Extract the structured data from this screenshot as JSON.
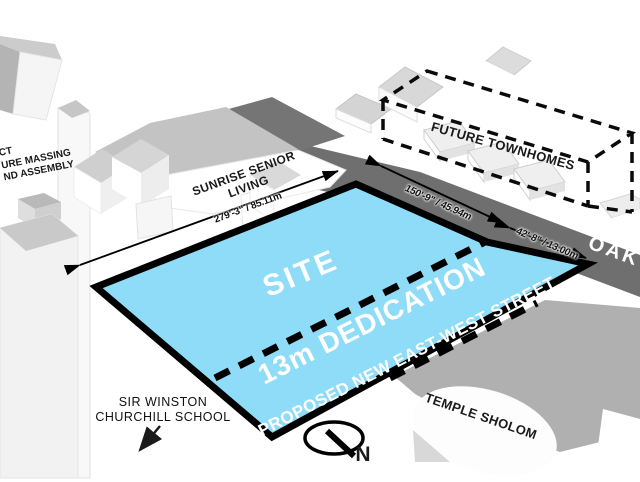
{
  "labels": {
    "site": "SITE",
    "dedication": "13m DEDICATION",
    "proposed_street": "PROPOSED NEW EAST-WEST STREET",
    "sunrise_line1": "SUNRISE SENIOR",
    "sunrise_line2": "LIVING",
    "future_townhomes": "FUTURE TOWNHOMES",
    "temple_sholom": "TEMPLE SHOLOM",
    "school_line1": "SIR WINSTON",
    "school_line2": "CHURCHILL SCHOOL",
    "oak_street": "OAK",
    "edge_note_line1": "CT",
    "edge_note_line2": "URE MASSING",
    "edge_note_line3": "ND ASSEMBLY"
  },
  "dimensions": {
    "west_frontage": "279'-3\" / 85.11m",
    "oak_frontage_site": "150'-9\" / 45.94m",
    "oak_frontage_dedication": "42'-8\" / 13.00m"
  },
  "compass": {
    "north_label": "N"
  },
  "colors": {
    "site_fill": "#8edcf8",
    "road_fill": "#6f6f6f",
    "outline_black": "#000000"
  }
}
